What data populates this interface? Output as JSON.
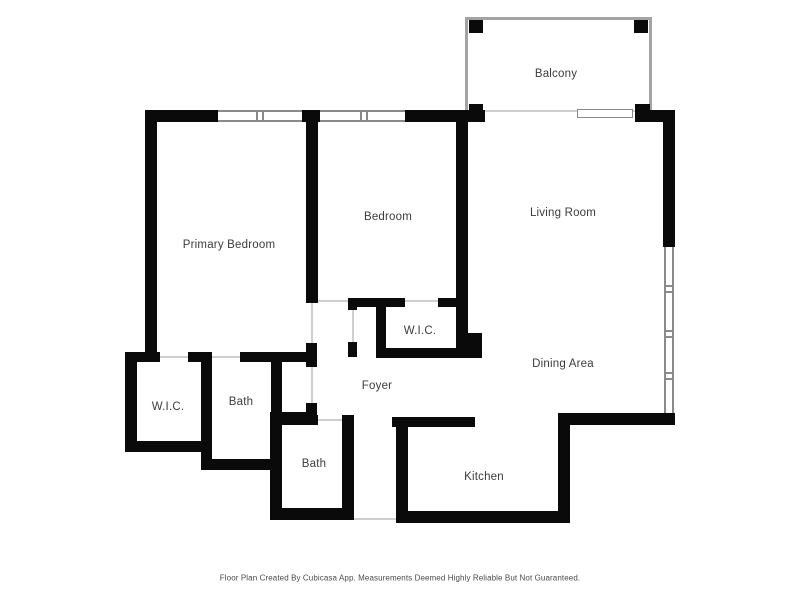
{
  "plan": {
    "source_note": "Floor Plan Created By Cubicasa App. Measurements Deemed Highly Reliable But Not Guaranteed.",
    "rooms": {
      "balcony": {
        "label": "Balcony"
      },
      "primary_bedroom": {
        "label": "Primary Bedroom"
      },
      "bedroom": {
        "label": "Bedroom"
      },
      "living_room": {
        "label": "Living Room"
      },
      "wic_hall": {
        "label": "W.I.C."
      },
      "dining_area": {
        "label": "Dining Area"
      },
      "foyer": {
        "label": "Foyer"
      },
      "wic_primary": {
        "label": "W.I.C."
      },
      "bath_primary": {
        "label": "Bath"
      },
      "bath_second": {
        "label": "Bath"
      },
      "kitchen": {
        "label": "Kitchen"
      }
    }
  },
  "colors": {
    "wall": "#0a0a0a",
    "window_frame": "#8a8a8a",
    "railing": "#a3a3a3",
    "door_line": "#cfcfcf",
    "label": "#3c3c3c",
    "footer": "#4a4a4a",
    "background": "#ffffff"
  }
}
